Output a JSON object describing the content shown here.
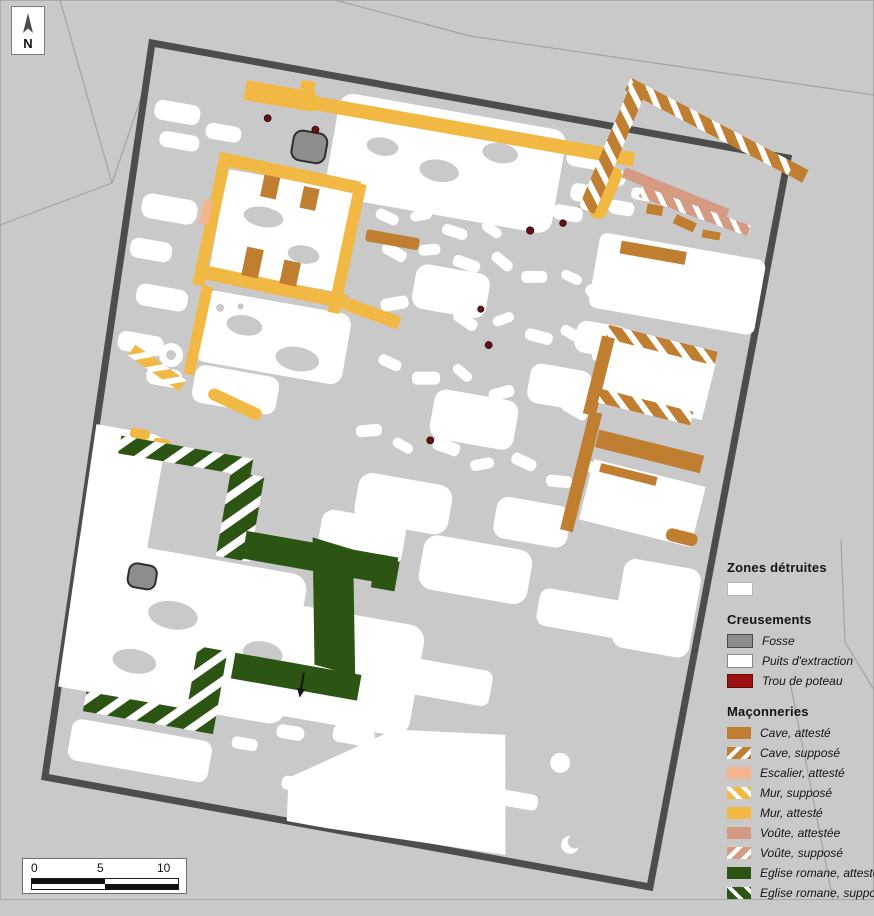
{
  "map": {
    "title": "Plan archéologique",
    "north_label": "N",
    "scale_ticks": [
      "0",
      "5",
      "10"
    ]
  },
  "legend": {
    "sections": [
      {
        "title": "Zones détruites",
        "items": [
          {
            "label": "",
            "key": "zones-detruites"
          }
        ]
      },
      {
        "title": "Creusements",
        "items": [
          {
            "label": "Fosse",
            "key": "fosse"
          },
          {
            "label": "Puits d'extraction",
            "key": "puits-extraction"
          },
          {
            "label": "Trou de poteau",
            "key": "trou-de-poteau"
          }
        ]
      },
      {
        "title": "Maçonneries",
        "items": [
          {
            "label": "Cave, attesté",
            "key": "cave-atteste"
          },
          {
            "label": "Cave, supposé",
            "key": "cave-suppose"
          },
          {
            "label": "Escalier, attesté",
            "key": "escalier-atteste"
          },
          {
            "label": "Mur, supposé",
            "key": "mur-suppose"
          },
          {
            "label": "Mur, attesté",
            "key": "mur-atteste"
          },
          {
            "label": "Voûte, attestée",
            "key": "voute-attestee"
          },
          {
            "label": "Voûte, supposé",
            "key": "voute-suppose"
          },
          {
            "label": "Eglise romane, attesté",
            "key": "eglise-romane-atteste"
          },
          {
            "label": "Eglise romane, supposé",
            "key": "eglise-romane-suppose"
          }
        ]
      }
    ]
  },
  "colors": {
    "background": "#c9c9c9",
    "map_border": "#4d4d4d",
    "zones_detruites": "#ffffff",
    "fosse": "#8d8d8d",
    "trou_de_poteau": "#9c1212",
    "cave": "#bf7e30",
    "escalier": "#f4b48e",
    "mur": "#f2b844",
    "voute": "#d49a82",
    "eglise_romane": "#2c5413"
  }
}
